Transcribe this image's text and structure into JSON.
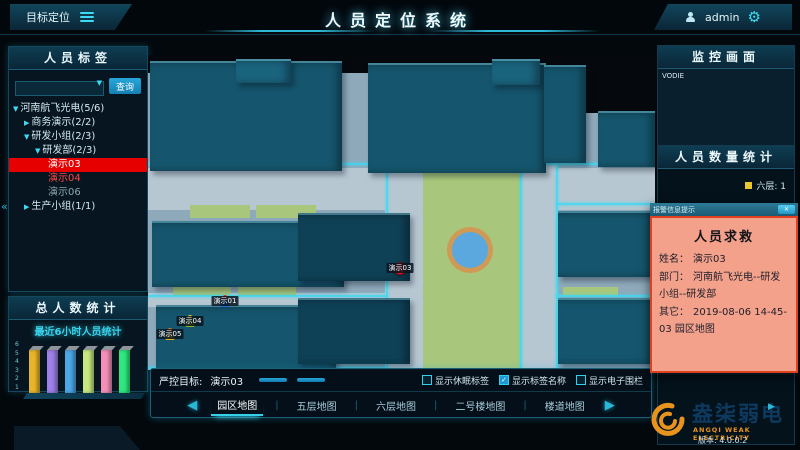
{
  "header": {
    "menu_button": "目标定位",
    "title": "人员定位系统",
    "user_name": "admin"
  },
  "icons": {
    "dropdown": "▼",
    "gear": "⚙",
    "check": "✓",
    "collapse": "«",
    "play": "▶",
    "prev_arrow": "◀",
    "next_arrow": "▶",
    "close": "✕"
  },
  "left_panel": {
    "tags_title": "人员标签",
    "search_button": "查询",
    "tree": [
      {
        "label": "河南航飞光电(5/6)",
        "level": 0,
        "arrow": "▼",
        "state": "normal"
      },
      {
        "label": "商务演示(2/2)",
        "level": 1,
        "arrow": "▶",
        "state": "normal"
      },
      {
        "label": "研发小组(2/3)",
        "level": 1,
        "arrow": "▼",
        "state": "normal"
      },
      {
        "label": "研发部(2/3)",
        "level": 2,
        "arrow": "▼",
        "state": "normal"
      },
      {
        "label": "演示03",
        "level": 3,
        "arrow": "",
        "state": "selected"
      },
      {
        "label": "演示04",
        "level": 3,
        "arrow": "",
        "state": "alert"
      },
      {
        "label": "演示06",
        "level": 3,
        "arrow": "",
        "state": "offline"
      },
      {
        "label": "生产小组(1/1)",
        "level": 1,
        "arrow": "▶",
        "state": "normal"
      }
    ],
    "total_title": "总人数统计"
  },
  "chart_data": {
    "type": "bar",
    "title": "最近6小时人员统计",
    "categories": [
      "",
      "",
      "",
      "",
      "",
      ""
    ],
    "values": [
      5,
      5,
      5,
      5,
      5,
      5
    ],
    "bar_colors": [
      "#e8b42a",
      "#9f7fe8",
      "#4da6e8",
      "#c8e87f",
      "#f48fb9",
      "#2ee87f"
    ],
    "xlabel": "",
    "ylabel": "",
    "ylim": [
      0,
      6
    ],
    "yticks": [
      1,
      2,
      3,
      4,
      5,
      6
    ],
    "grid": false,
    "legend": false
  },
  "map": {
    "labels": [
      {
        "text": "15F",
        "x": 87,
        "y": 30,
        "cls": "lbl-md"
      },
      {
        "text": "11号楼",
        "x": 272,
        "y": 40,
        "cls": "lbl-lg"
      },
      {
        "text": "15F",
        "x": 418,
        "y": 38,
        "cls": "lbl-md"
      },
      {
        "text": "迎春街",
        "x": 472,
        "y": 33,
        "cls": "lbl-street"
      },
      {
        "text": "北门",
        "x": 157,
        "y": 68,
        "cls": "lbl-gate"
      },
      {
        "text": "1",
        "x": 157,
        "y": 79,
        "cls": "lbl-gate"
      },
      {
        "text": "北门",
        "x": 424,
        "y": 73,
        "cls": "lbl-gate"
      },
      {
        "text": "2",
        "x": 424,
        "y": 84,
        "cls": "lbl-gate"
      },
      {
        "text": "丹尼斯",
        "x": 477,
        "y": 82,
        "cls": "lbl-sm"
      },
      {
        "text": "3号楼",
        "x": 84,
        "y": 197,
        "cls": "lbl-lg"
      },
      {
        "text": "7F",
        "x": 187,
        "y": 183,
        "cls": "lbl-md"
      },
      {
        "text": "精华",
        "x": 487,
        "y": 188,
        "cls": "lbl-lg"
      },
      {
        "text": "7F",
        "x": 187,
        "y": 262,
        "cls": "lbl-md"
      },
      {
        "text": "2号楼",
        "x": 103,
        "y": 278,
        "cls": "lbl-xl"
      }
    ],
    "markers": [
      {
        "name": "演示03",
        "x": 252,
        "y": 207,
        "kind": "dot"
      },
      {
        "name": "演示01",
        "x": 77,
        "y": 240,
        "kind": "person",
        "head": "#e03020",
        "body": "#2468d8"
      },
      {
        "name": "演示04",
        "x": 42,
        "y": 260,
        "kind": "person",
        "head": "#e8d020",
        "body": "#88b020"
      },
      {
        "name": "演示05",
        "x": 22,
        "y": 273,
        "kind": "person",
        "head": "#e87818",
        "body": "#d8b020"
      }
    ]
  },
  "controls": {
    "target_label": "严控目标:",
    "target_value": "演示03",
    "buttons": [
      {
        "label": "取消严控"
      },
      {
        "label": "亏电人员"
      }
    ],
    "checkboxes": [
      {
        "label": "显示休眠标签",
        "checked": false
      },
      {
        "label": "显示标签名称",
        "checked": true
      },
      {
        "label": "显示电子围栏",
        "checked": false
      }
    ],
    "tabs": [
      "园区地图",
      "五层地图",
      "六层地图",
      "二号楼地图",
      "楼道地图"
    ],
    "active_tab": "园区地图",
    "tab_separator": "|"
  },
  "right_panel": {
    "monitor_title": "监控画面",
    "video_label": "VODIE",
    "count_title": "人员数量统计",
    "legend_label": "六层: 1",
    "legend_color": "#e8c832"
  },
  "popup": {
    "title": "报警信息提示",
    "alert_title": "人员求救",
    "fields": [
      {
        "label": "姓名：",
        "value": "演示03"
      },
      {
        "label": "部门：",
        "value": "河南航飞光电--研发小组--研发部"
      },
      {
        "label": "其它：",
        "value": "2019-08-06 14-45-03 园区地图"
      }
    ]
  },
  "footer": {
    "brand": "盎柒弱电",
    "brand_sub": "ANGQI WEAK ELECTRICITY",
    "version": "版本: 4.0.0.2"
  },
  "colors": {
    "accent": "#35d0ea",
    "alert_red": "#e60000",
    "button_blue": "#1b9ad4",
    "popup_border": "#e04020",
    "popup_bg": "#f4a18c"
  }
}
